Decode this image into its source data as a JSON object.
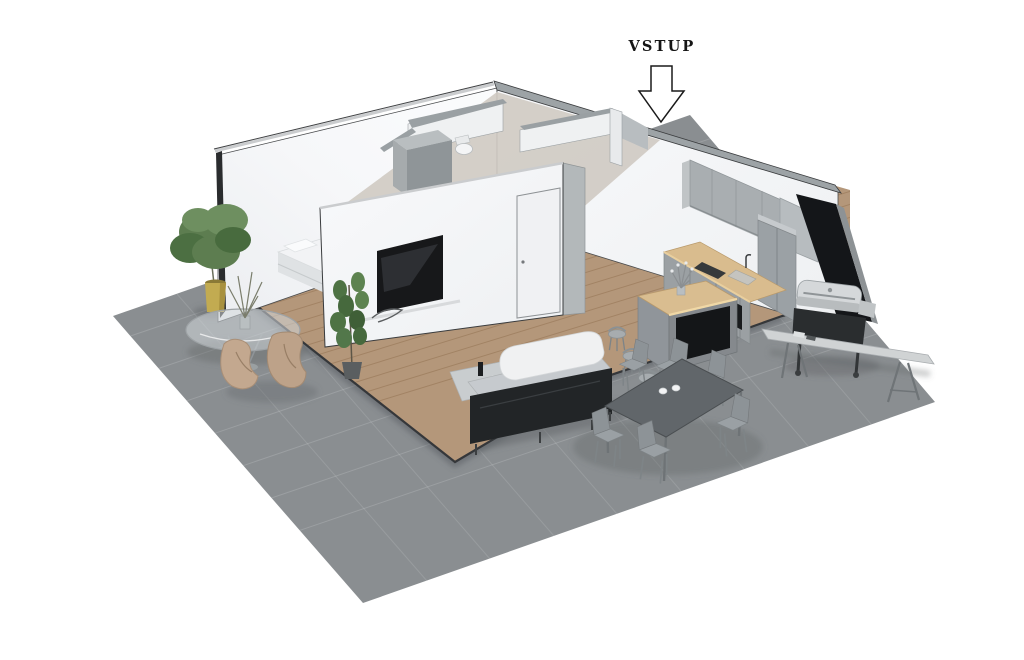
{
  "annotation": {
    "entrance_label": "VSTUP",
    "entrance_arrow_icon": "down-arrow-icon"
  },
  "scene": {
    "type": "isometric-apartment-cutaway-render",
    "objects": [
      "outdoor-terrace",
      "wood-floor",
      "bed",
      "wardrobe",
      "toilet",
      "tv-wall",
      "tv",
      "interior-door",
      "indoor-plant",
      "potted-tree",
      "round-glass-table",
      "lounge-chair",
      "sofa",
      "side-table",
      "kitchen-upper-cabinets",
      "kitchen-counter",
      "tall-cabinet",
      "kitchen-island",
      "bar-stool",
      "dining-table",
      "dining-chair",
      "coffee-cups",
      "bbq-grill",
      "outdoor-bench"
    ]
  },
  "colors": {
    "background": "#ffffff",
    "terrace_tile": "#8a8e91",
    "wood_floor": "#b4977a",
    "wall_white": "#f5f6f8",
    "wall_top_gray": "#9da3a6",
    "wall_cut_dark": "#141619",
    "counter_wood": "#d9bc8e",
    "cabinet_gray": "#a2a7ab",
    "sofa_dark": "#222527",
    "pot_yellow": "#c2ab51",
    "plant_green": "#5d7d50",
    "label_text": "#151515"
  }
}
